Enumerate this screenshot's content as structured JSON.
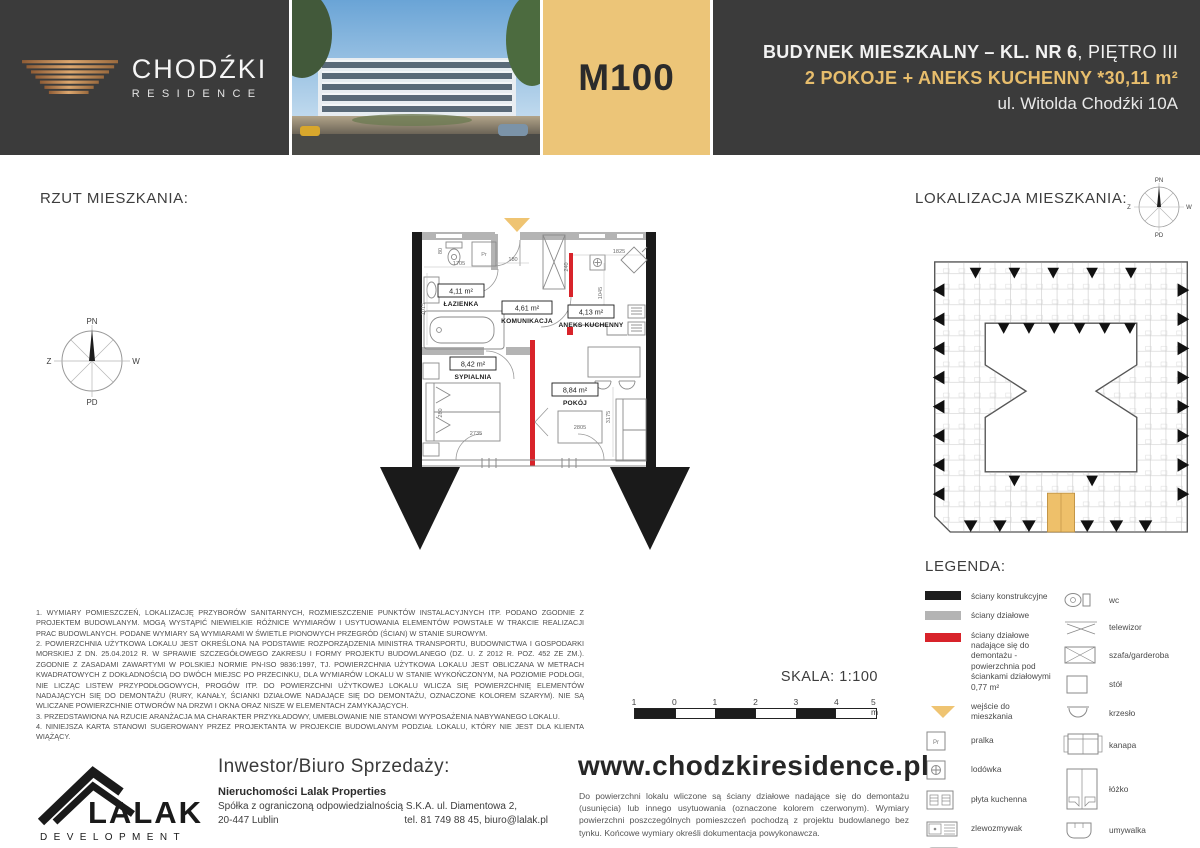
{
  "header": {
    "brand": {
      "name": "CHODŹKI",
      "sub": "RESIDENCE"
    },
    "unit_id": "M100",
    "info": {
      "line1_bold": "BUDYNEK MIESZKALNY – KL. NR 6",
      "line1_rest": ", PIĘTRO III",
      "line2": "2 POKOJE + ANEKS KUCHENNY *30,11 m²",
      "line3": "ul. Witolda Chodźki 10A"
    }
  },
  "sections": {
    "plan_title": "RZUT MIESZKANIA:",
    "location_title": "LOKALIZACJA MIESZKANIA:",
    "legend_title": "LEGENDA:",
    "scale_label": "SKALA: 1:100"
  },
  "compass": {
    "n": "PN",
    "s": "PD",
    "w": "Z",
    "e": "W"
  },
  "floor_plan": {
    "pr_label": "Pr",
    "rooms": [
      {
        "area": "4,11 m²",
        "name": "ŁAZIENKA"
      },
      {
        "area": "4,61 m²",
        "name": "KOMUNIKACJA"
      },
      {
        "area": "4,13 m²",
        "name": "ANEKS KUCHENNY"
      },
      {
        "area": "8,42 m²",
        "name": "SYPIALNIA"
      },
      {
        "area": "8,84 m²",
        "name": "POKÓJ"
      }
    ],
    "dims": {
      "bath_w": "1705",
      "entry": "180",
      "kitchen_w": "1825",
      "wardrobe_h": "240",
      "kitchen_h": "1045",
      "bath_h": "1015",
      "wc_w": "80",
      "bed_w": "2735",
      "bed_h": "280",
      "desk_w": "2805",
      "room_h": "3175"
    }
  },
  "legend": {
    "left": [
      {
        "label": "ściany konstrukcyjne"
      },
      {
        "label": "ściany działowe"
      },
      {
        "label": "ściany działowe nadające się do demontażu - powierzchnia pod ściankami działowymi 0,77 m²"
      },
      {
        "label": "wejście do mieszkania"
      },
      {
        "label": "pralka"
      },
      {
        "label": "lodówka"
      },
      {
        "label": "płyta kuchenna"
      },
      {
        "label": "zlewozmywak"
      },
      {
        "label": "wanna"
      }
    ],
    "right": [
      {
        "label": "wc"
      },
      {
        "label": "telewizor"
      },
      {
        "label": "szafa/garderoba"
      },
      {
        "label": "stół"
      },
      {
        "label": "krzesło"
      },
      {
        "label": "kanapa"
      },
      {
        "label": "łóżko"
      },
      {
        "label": "umywalka"
      }
    ]
  },
  "scale_bar": {
    "ticks": [
      "1",
      "0",
      "1",
      "2",
      "3",
      "4",
      "5 m"
    ]
  },
  "notes": [
    "1. WYMIARY POMIESZCZEŃ, LOKALIZACJĘ PRZYBORÓW SANITARNYCH, ROZMIESZCZENIE PUNKTÓW INSTALACYJNYCH ITP. PODANO ZGODNIE Z PROJEKTEM BUDOWLANYM. MOGĄ WYSTĄPIĆ NIEWIELKIE RÓŻNICE WYMIARÓW I USYTUOWANIA ELEMENTÓW POWSTAŁE W TRAKCIE REALIZACJI PRAC BUDOWLANYCH. PODANE WYMIARY SĄ WYMIARAMI W ŚWIETLE PIONOWYCH PRZEGRÓD (ŚCIAN) W STANIE SUROWYM.",
    "2. POWIERZCHNIA UŻYTKOWA LOKALU JEST OKREŚLONA NA PODSTAWIE ROZPORZĄDZENIA MINISTRA TRANSPORTU, BUDOWNICTWA I GOSPODARKI MORSKIEJ Z DN. 25.04.2012 R. W SPRAWIE SZCZEGÓŁOWEGO ZAKRESU I FORMY PROJEKTU BUDOWLANEGO (DZ. U. Z 2012 R. POZ. 452 ZE ZM.). ZGODNIE Z ZASADAMI ZAWARTYMI W POLSKIEJ NORMIE PN-ISO 9836:1997, TJ. POWIERZCHNIA UŻYTKOWA LOKALU JEST OBLICZANA W METRACH KWADRATOWYCH Z DOKŁADNOŚCIĄ DO DWÓCH MIEJSC PO PRZECINKU, DLA WYMIARÓW LOKALU W STANIE WYKOŃCZONYM, NA POZIOMIE PODŁOGI, NIE LICZĄC LISTEW PRZYPODŁOGOWYCH, PROGÓW ITP. DO POWIERZCHNI UŻYTKOWEJ LOKALU WLICZA SIĘ POWIERZCHNIĘ ELEMENTÓW NADAJĄCYCH SIĘ DO DEMONTAŻU (RURY, KANAŁY, ŚCIANKI DZIAŁOWE NADAJĄCE SIĘ DO DEMONTAŻU, OZNACZONE KOLOREM SZARYM). NIE SĄ WLICZANE POWIERZCHNIE OTWORÓW NA DRZWI I OKNA ORAZ NISZE W ELEMENTACH ZAMYKAJĄCYCH.",
    "3. PRZEDSTAWIONA NA RZUCIE ARANŻACJA MA CHARAKTER PRZYKŁADOWY, UMEBLOWANIE NIE STANOWI WYPOSAŻENIA NABYWANEGO LOKALU.",
    "4. NINIEJSZA KARTA STANOWI SUGEROWANY PRZEZ PROJEKTANTA W PROJEKCIE BUDOWLANYM PODZIAŁ LOKALU, KTÓRY NIE JEST DLA KLIENTA WIĄŻĄCY."
  ],
  "footer": {
    "investor_title": "Inwestor/Biuro Sprzedaży:",
    "company": "Nieruchomości Lalak Properties",
    "address1": "Spółka z ograniczoną odpowiedzialnością S.K.A. ul. Diamentowa 2,",
    "address2": "20-447 Lublin",
    "contact": "tel. 81 749 88 45, biuro@lalak.pl",
    "website": "www.chodzkiresidence.pl",
    "website_note": "Do powierzchni lokalu wliczone są ściany działowe nadające się do demontażu (usunięcia) lub innego usytuowania (oznaczone kolorem czerwonym). Wymiary powierzchni poszczególnych pomieszczeń pochodzą z projektu budowlanego bez tynku. Końcowe wymiary określi dokumentacja powykonawcza.",
    "logo_text": "LALAK",
    "logo_sub": "DEVELOPMENT"
  },
  "colors": {
    "accent_gold": "#ecc578",
    "dark": "#3b3b3b",
    "red": "#d8232a",
    "wall_gray": "#b4b4b4"
  }
}
